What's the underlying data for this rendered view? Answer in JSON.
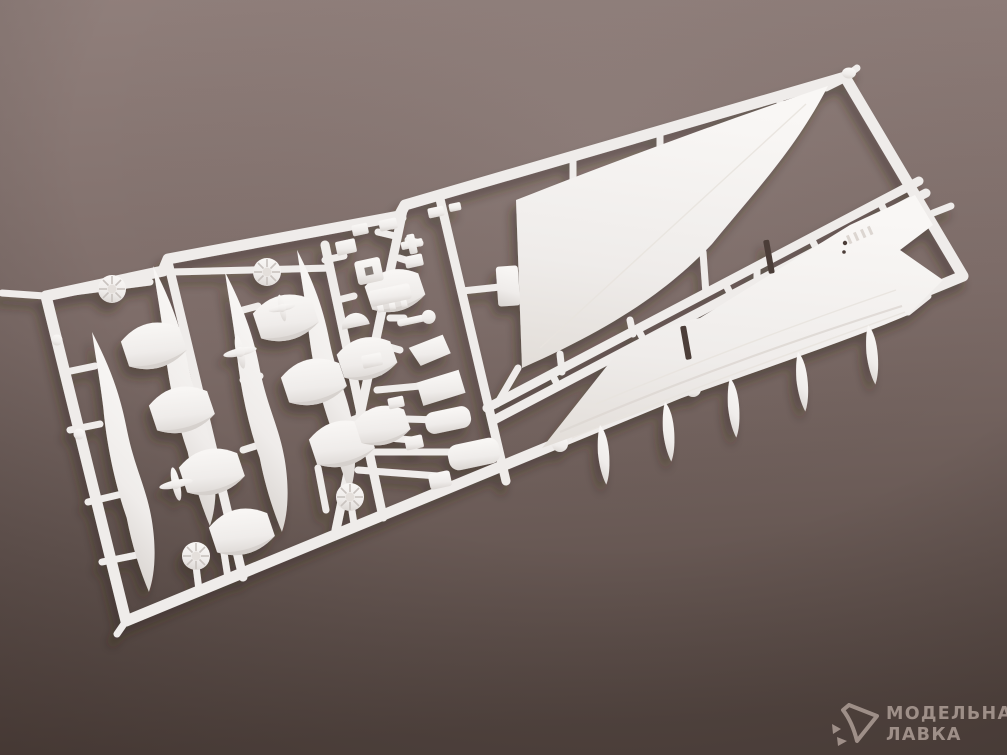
{
  "scene": {
    "subject": "White polystyrene model-kit sprue with supersonic-airliner parts (two large delta wing panels, engine nacelle halves, intake cowl segments, turbine fan discs, propeller hubs and small detail parts) photographed at an angle on a mauve-brown studio backdrop",
    "colors": {
      "background_top": "#907f7b",
      "background_mid": "#7d6c68",
      "background_bottom": "#584a45",
      "plastic": "#efecea",
      "plastic_bright": "#f8f6f4",
      "plastic_shadow": "#d8d3cf",
      "slot": "#4b3d37",
      "watermark": "#a6968f"
    }
  },
  "sprue": {
    "parts": [
      "runner-frame",
      "delta-wing-upper-panel",
      "delta-wing-lower-panel-with-fuselage",
      "engine-nacelle-side-halves",
      "intake-cowl-segments",
      "turbine-fan-discs",
      "propeller-hub-crosses",
      "landing-gear-and-small-detail-parts",
      "wing-fences"
    ]
  },
  "watermark": {
    "logo": "cursor-arrow-logo-icon",
    "line1": "МОДЕЛЬНАЯ",
    "line2": "ЛАВКА"
  }
}
